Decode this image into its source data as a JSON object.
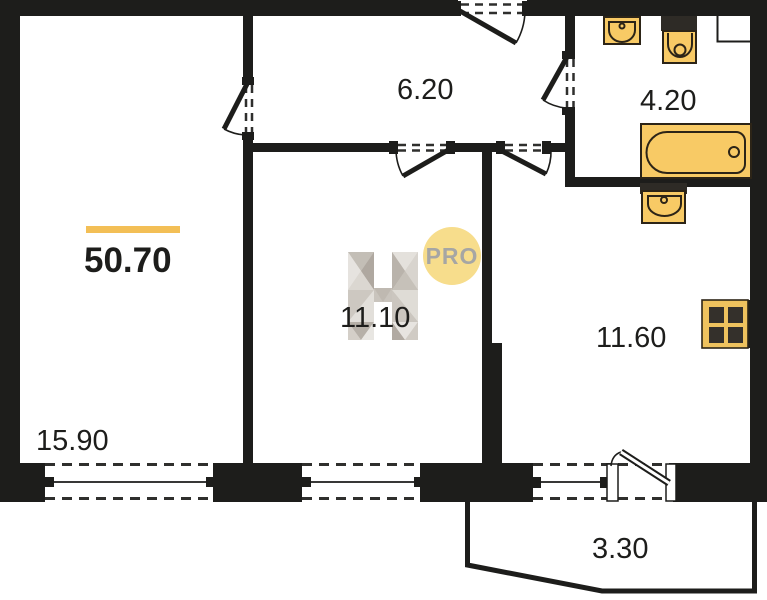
{
  "plan": {
    "total_area": "50.70",
    "rooms": [
      {
        "id": "living-room",
        "area": "15.90"
      },
      {
        "id": "bedroom",
        "area": "11.10"
      },
      {
        "id": "hallway",
        "area": "6.20"
      },
      {
        "id": "bathroom",
        "area": "4.20"
      },
      {
        "id": "kitchen",
        "area": "11.60"
      },
      {
        "id": "balcony",
        "area": "3.30"
      }
    ],
    "colors": {
      "wall": "#1D1D1B",
      "accent": "#F3BF56",
      "fixture": "#F8CA65",
      "badge": "#F7DD8C"
    },
    "watermark": {
      "badge_text": "PRO"
    },
    "fixtures": [
      "washbasin",
      "toilet",
      "bathtub",
      "kitchen-sink",
      "stove"
    ]
  }
}
